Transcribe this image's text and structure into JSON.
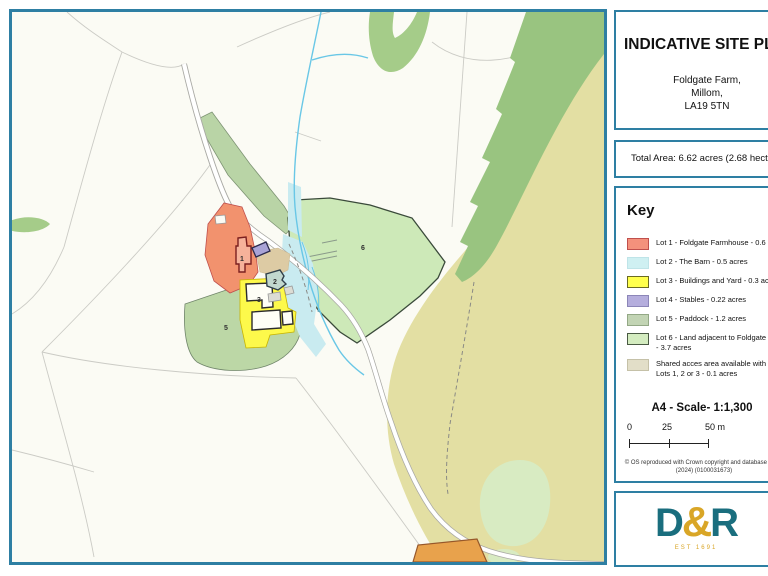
{
  "panel": {
    "title": "INDICATIVE SITE PLAN",
    "address_line1": "Foldgate Farm,",
    "address_line2": "Millom,",
    "address_line3": "LA19 5TN",
    "total_area": "Total Area: 6.62 acres (2.68 hectares)",
    "key_heading": "Key",
    "key_items": [
      {
        "label": "Lot 1 - Foldgate Farmhouse - 0.6 acres",
        "color": "#F4917C",
        "border": "#C0504D"
      },
      {
        "label": "Lot 2 - The Barn - 0.5 acres",
        "color": "#CFF0F2",
        "border": "#BFE4E8"
      },
      {
        "label": "Lot 3 - Buildings and Yard - 0.3 acres",
        "color": "#FFFF4D",
        "border": "#6B6B22"
      },
      {
        "label": "Lot 4 - Stables - 0.22 acres",
        "color": "#B5AEDD",
        "border": "#8C86B8"
      },
      {
        "label": "Lot 5 - Paddock - 1.2 acres",
        "color": "#C2D4B4",
        "border": "#93A886"
      },
      {
        "label": "Lot 6 - Land adjacent to Foldgate Farm",
        "label2": "- 3.7 acres",
        "color": "#D4ECC0",
        "border": "#4A5A44"
      },
      {
        "label": "Shared acces area available with",
        "label2": "Lots 1, 2 or 3 - 0.1 acres",
        "color": "#E2DEC8",
        "border": "#C5C1A8"
      }
    ],
    "scale_title": "A4 - Scale- 1:1,300",
    "scale_tick_0": "0",
    "scale_tick_25": "25",
    "scale_tick_50": "50 m",
    "copyright_line1": "© OS reproduced with Crown copyright and database rights",
    "copyright_line2": "(2024) (0100031673)",
    "logo": {
      "d": "D",
      "amp": "&",
      "r": "R",
      "est": "EST 1691"
    }
  },
  "map": {
    "labels": [
      {
        "text": "1"
      },
      {
        "text": "2"
      },
      {
        "text": "3"
      },
      {
        "text": "5"
      },
      {
        "text": "6"
      }
    ]
  },
  "colors": {
    "frame": "#2E7FA3",
    "map_background": "#FBFBF4",
    "lot1": "#F2926E",
    "lot1_outline": "#C0504D",
    "lot2_land": "#C9EBF0",
    "lot3": "#FDF94B",
    "lot4": "#A9A3D6",
    "lot5": "#BCD7A6",
    "lot6": "#CDE9B8",
    "shared_access": "#DDCBA4",
    "khaki_moorland": "#E3DFA3",
    "woodland": "#99C480",
    "woodland_light": "#A5CC89",
    "pale_green_patch": "#D8EBC2",
    "stream": "#69C7E6",
    "road_casing": "#A9A9A4",
    "orange_patch": "#E8A24C",
    "logo_teal": "#1A6E7E",
    "logo_gold": "#D9A627"
  }
}
